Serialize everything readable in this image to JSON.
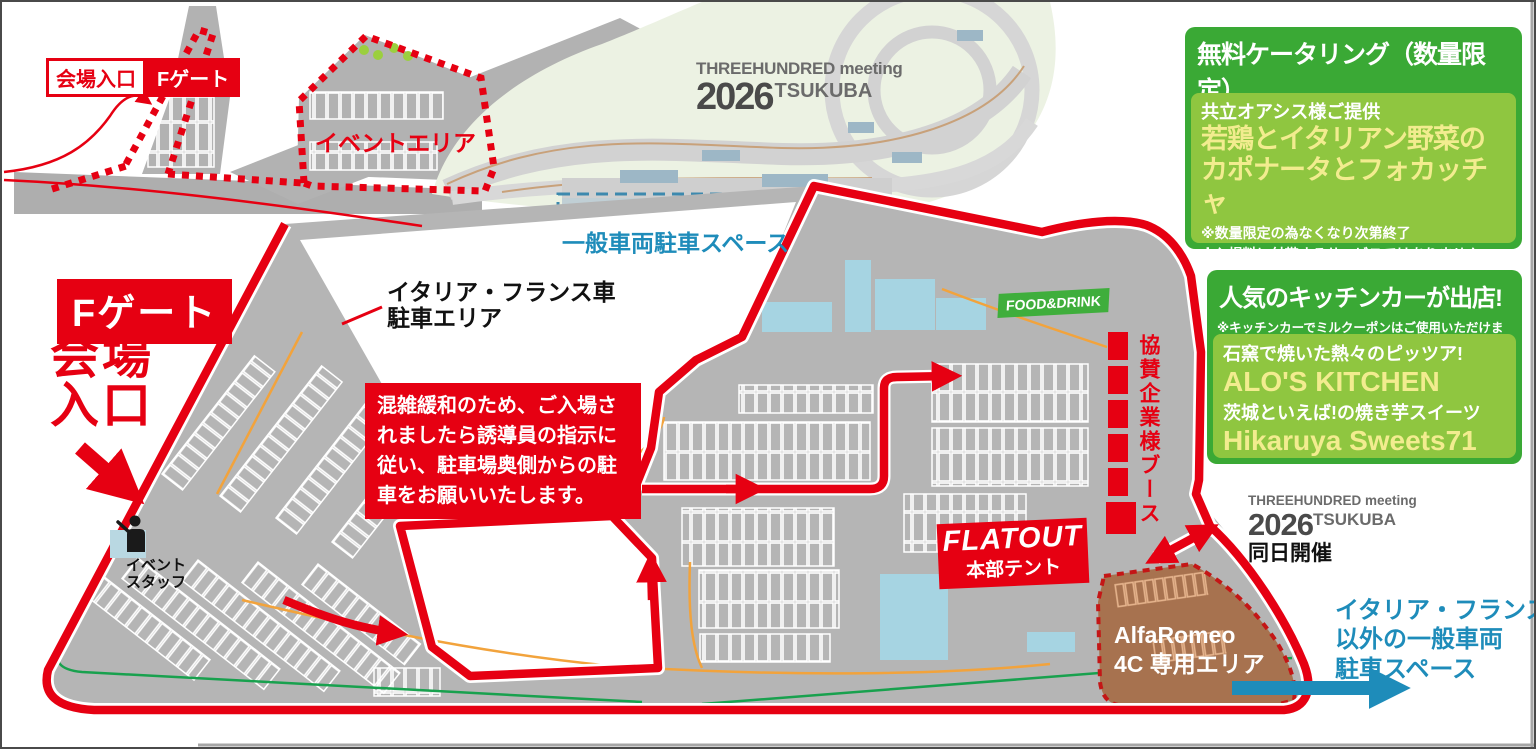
{
  "colors": {
    "accent_red": "#e60012",
    "green_dark": "#3aa935",
    "green_light": "#8fc640",
    "menu_yellow": "#f2ec8f",
    "info_blue": "#1e8cba",
    "alfa_brown": "#a7724f",
    "map_gray": "#b5b5b5"
  },
  "top_left": {
    "entrance_box": "会場入口",
    "gate_box": "Fゲート",
    "event_area": "イベントエリア"
  },
  "circuit_logo": {
    "brand": "THREEHUNDRED meeting",
    "year": "2026",
    "venue": "TSUKUBA"
  },
  "general_parking": {
    "label": "一般車両駐車スペース"
  },
  "left_side": {
    "gate_big": "Fゲート",
    "entrance_line1": "会場",
    "entrance_line2": "入口",
    "staff_line1": "イベント",
    "staff_line2": "スタッフ"
  },
  "parking_area_label": {
    "line1": "イタリア・フランス車",
    "line2": "駐車エリア"
  },
  "congestion_notice": {
    "text": "混雑緩和のため、ご入場されましたら誘導員の指示に従い、駐車場奥側からの駐車をお願いいたします。"
  },
  "center": {
    "food_drink": "FOOD&DRINK",
    "sponsor_booths": "協賛企業様ブース",
    "flatout": "FLATOUT",
    "flatout_sub": "本部テント"
  },
  "same_day": {
    "brand": "THREEHUNDRED meeting",
    "year": "2026",
    "venue": "TSUKUBA",
    "note": "同日開催"
  },
  "alfa_area": {
    "line1": "AlfaRomeo",
    "line2": "4C 専用エリア"
  },
  "other_parking": {
    "line1": "イタリア・フランス車",
    "line2": "以外の一般車両",
    "line3": "駐車スペース"
  },
  "catering_box": {
    "title": "無料ケータリング（数量限定）",
    "subtitle": "受付でミルクーポンを配布します。",
    "provider": "共立オアシス様ご提供",
    "menu_line1": "若鶏とイタリアン野菜の",
    "menu_line2": "カポナータとフォカッチャ",
    "note1": "※数量限定の為なくなり次第終了",
    "note2": "※入場料に付帯するサービスではありません。"
  },
  "kitchen_box": {
    "title": "人気のキッチンカーが出店!",
    "note": "※キッチンカーでミルクーポンはご使用いただけません。",
    "item1_desc": "石窯で焼いた熱々のピッツア!",
    "item1_name": "ALO'S KITCHEN",
    "item2_desc": "茨城といえば!の焼き芋スイーツ",
    "item2_name": "Hikaruya Sweets71"
  }
}
